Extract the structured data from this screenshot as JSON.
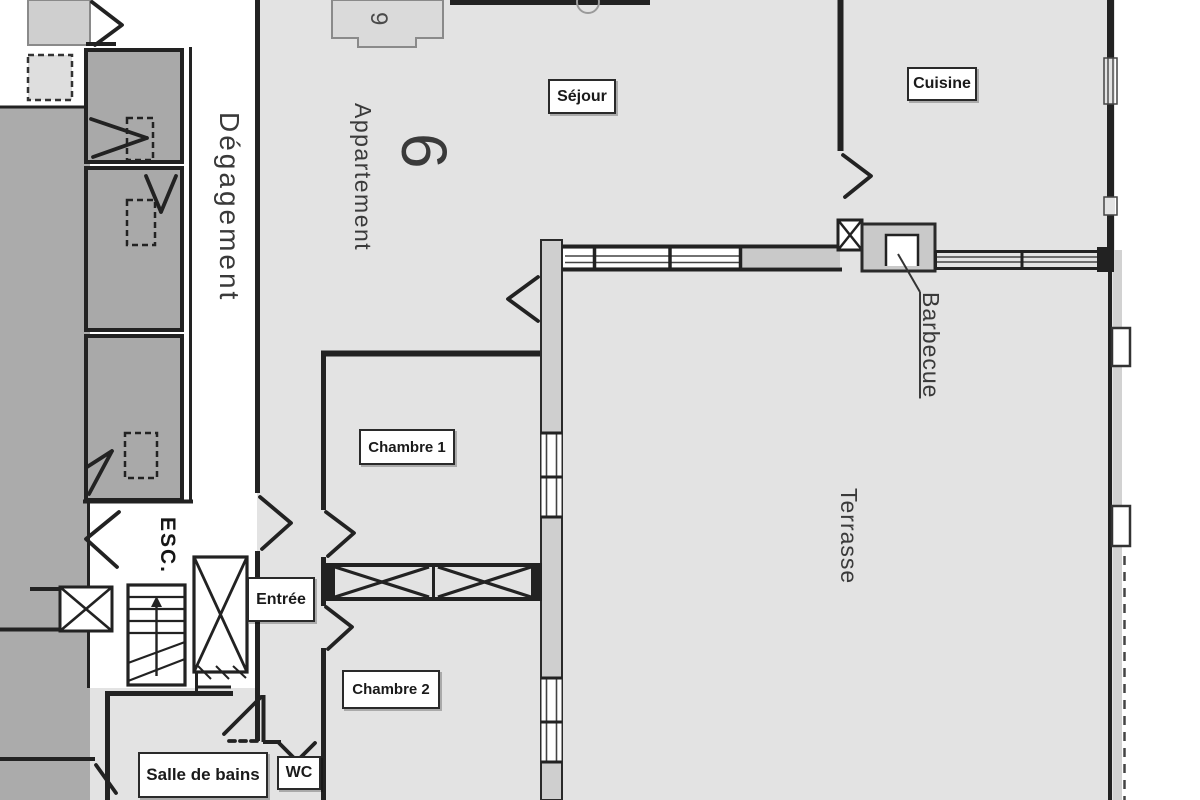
{
  "floorplan": {
    "unit": {
      "vertical_title": "Appartement",
      "number": "6"
    },
    "rooms": {
      "sejour": "Séjour",
      "cuisine": "Cuisine",
      "chambre1": "Chambre 1",
      "chambre2": "Chambre 2",
      "entree": "Entrée",
      "salle_de_bains": "Salle de bains",
      "wc": "WC",
      "terrasse": "Terrasse",
      "degagement": "Dégagement",
      "escalier": "ESC.",
      "barbecue": "Barbecue"
    },
    "annotations": {
      "small_number": "9"
    },
    "colors": {
      "floor": "#e3e3e3",
      "common_floor": "#ababab",
      "neighbor_room": "#a9a9a9",
      "corridor": "#ffffff",
      "wall": "#222222",
      "wall_light_fill": "#cfcfcf",
      "window_frame": "#444444",
      "label_border": "#2a2a2a",
      "label_text": "#1a1a1a",
      "vertical_text": "#3a3a3a"
    }
  }
}
